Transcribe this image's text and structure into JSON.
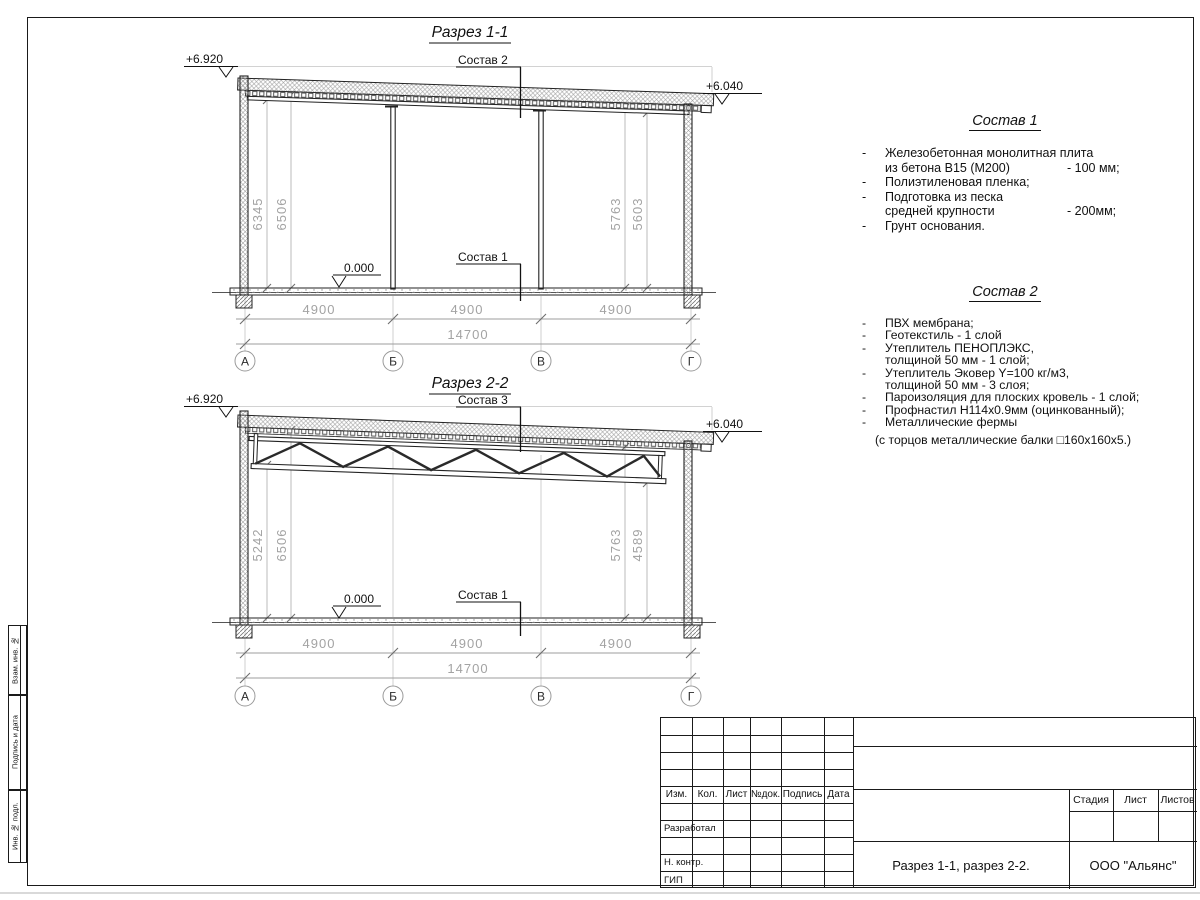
{
  "s1": {
    "title": "Разрез 1-1",
    "elev_left": "+6.920",
    "elev_right": "+6.040",
    "roof_label": "Состав 2",
    "floor_label": "Состав 1",
    "zero_mark": "0.000",
    "dim_left_outer": "6345",
    "dim_left_inner": "6506",
    "dim_right_inner": "5763",
    "dim_right_outer": "5603",
    "span1": "4900",
    "span2": "4900",
    "span3": "4900",
    "total": "14700",
    "axis1": "А",
    "axis2": "Б",
    "axis3": "В",
    "axis4": "Г"
  },
  "s2": {
    "title": "Разрез 2-2",
    "elev_left": "+6.920",
    "elev_right": "+6.040",
    "roof_label": "Состав 3",
    "floor_label": "Состав 1",
    "zero_mark": "0.000",
    "dim_left_outer": "5242",
    "dim_left_inner": "6506",
    "dim_right_inner": "5763",
    "dim_right_outer": "4589",
    "span1": "4900",
    "span2": "4900",
    "span3": "4900",
    "total": "14700",
    "axis1": "А",
    "axis2": "Б",
    "axis3": "В",
    "axis4": "Г"
  },
  "comp1": {
    "heading": "Состав 1",
    "items": [
      {
        "d": "-",
        "t": "Железобетонная  монолитная плита"
      },
      {
        "t": "из бетона В15 (М200)",
        "v": "- 100 мм;"
      },
      {
        "d": "-",
        "t": "Полиэтиленовая пленка;"
      },
      {
        "d": "-",
        "t": "Подготовка из песка"
      },
      {
        "t": "средней крупности",
        "v": "- 200мм;"
      },
      {
        "d": "-",
        "t": "Грунт основания."
      }
    ]
  },
  "comp2": {
    "heading": "Состав 2",
    "items": [
      {
        "d": "-",
        "t": "ПВХ мембрана;"
      },
      {
        "d": "-",
        "t": "Геотекстиль - 1 слой"
      },
      {
        "d": "-",
        "t": "Утеплитель ПЕНОПЛЭКС,"
      },
      {
        "t": "толщиной 50 мм - 1 слой;"
      },
      {
        "d": "-",
        "t": "Утеплитель Эковер Y=100 кг/м3,"
      },
      {
        "t": "толщиной 50 мм - 3 слоя;"
      },
      {
        "d": "-",
        "t": "Пароизоляция для плоских кровель - 1 слой;"
      },
      {
        "d": "-",
        "t": "Профнастил Н114х0.9мм (оцинкованный);"
      },
      {
        "d": "-",
        "t": "Металлические фермы"
      }
    ],
    "footnote": "(с торцов металлические балки □160х160х5.)"
  },
  "titleblock": {
    "cols": [
      "Изм.",
      "Кол.",
      "Лист",
      "№док.",
      "Подпись",
      "Дата"
    ],
    "row_developed": "Разработал",
    "row_ncontr": "Н. контр.",
    "row_gip": "ГИП",
    "stage": "Стадия",
    "sheet": "Лист",
    "sheets": "Листов",
    "doc_title": "Разрез 1-1, разрез 2-2.",
    "org": "ООО \"Альянс\""
  },
  "stamps": [
    "Взам. инв. №",
    "Подпись и дата",
    "Инв. № подл."
  ]
}
